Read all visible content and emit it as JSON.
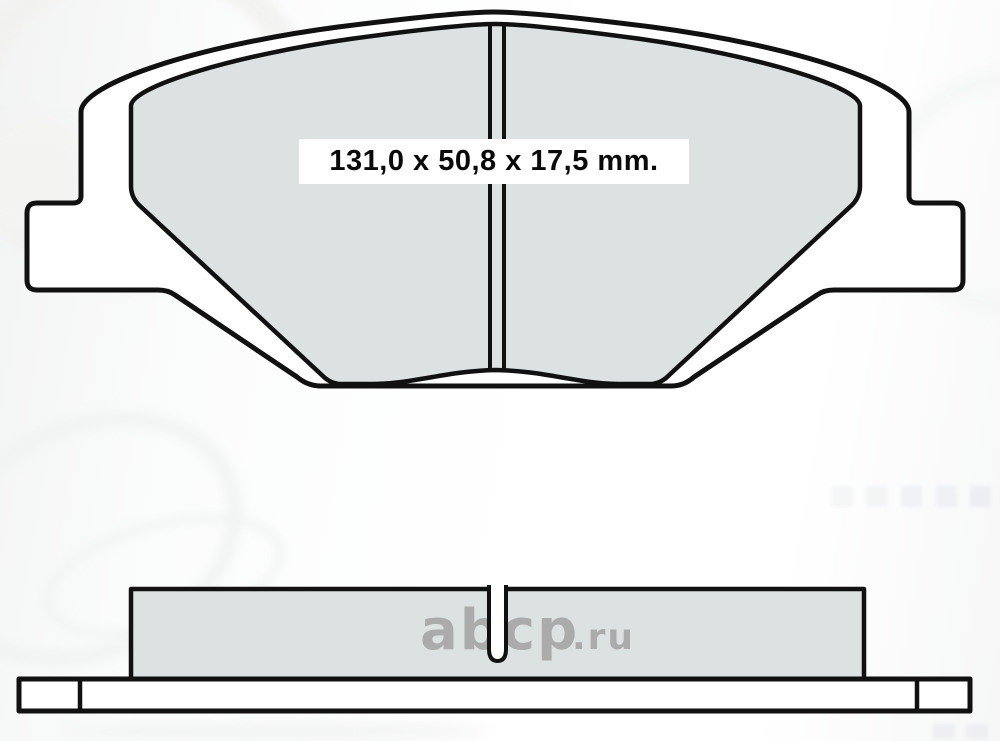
{
  "drawing": {
    "dimension_label": "131,0 x 50,8 x 17,5 mm.",
    "colors": {
      "outline": "#111111",
      "plate_fill": "#ffffff",
      "friction_fill": "#dce1e1",
      "label_bg": "#ffffff",
      "label_text": "#0a0a0a",
      "watermark": "#a6a6a6"
    }
  },
  "watermark": {
    "brand": "abcp",
    "tld": ".ru"
  }
}
